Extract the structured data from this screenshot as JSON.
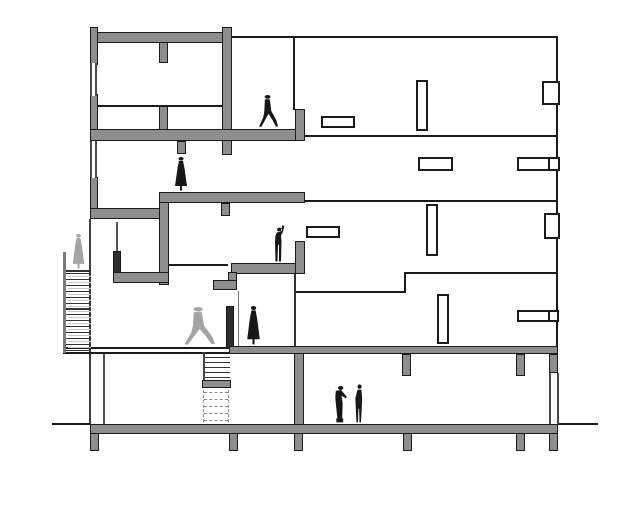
{
  "drawing": {
    "canvas": {
      "w": 635,
      "h": 515
    },
    "palette": {
      "background": "#ffffff",
      "cut_wall_gray": "#8e8e8e",
      "outline_black": "#1b1b1b",
      "dark_wall": "#2e2e2e",
      "light_figure_gray": "#a4a4a4",
      "dark_figure": "#171717",
      "tread_light": "#c7c7c7",
      "dashed_gray": "#8a8a8a"
    },
    "thin_lines": [
      {
        "n": "roof-edge-line",
        "x": 231,
        "y": 36,
        "w": 327,
        "h": 2
      },
      {
        "n": "right-facade-line",
        "x": 556,
        "y": 36,
        "w": 2,
        "h": 312
      },
      {
        "n": "mid-facade-line",
        "x": 293,
        "y": 38,
        "w": 2,
        "h": 72
      },
      {
        "n": "floor2-line",
        "x": 303,
        "y": 135,
        "w": 255,
        "h": 2
      },
      {
        "n": "floor3-line",
        "x": 303,
        "y": 200,
        "w": 255,
        "h": 2
      },
      {
        "n": "floor4-high-line",
        "x": 404,
        "y": 272,
        "w": 154,
        "h": 2
      },
      {
        "n": "floor4-step-line",
        "x": 404,
        "y": 272,
        "w": 2,
        "h": 21
      },
      {
        "n": "floor4-low-line",
        "x": 296,
        "y": 291,
        "w": 110,
        "h": 2
      },
      {
        "n": "mezzanine-line",
        "x": 97,
        "y": 105,
        "w": 126,
        "h": 2
      },
      {
        "n": "left-facade-line",
        "x": 89,
        "y": 219,
        "w": 2,
        "h": 206,
        "c": "#3d3d3d"
      },
      {
        "n": "partition-line",
        "x": 103,
        "y": 353,
        "w": 2,
        "h": 72,
        "c": "#555555"
      },
      {
        "n": "rail-line-upper",
        "x": 116,
        "y": 222,
        "w": 2,
        "h": 31,
        "c": "#555555"
      },
      {
        "n": "rail-line-mid",
        "x": 168,
        "y": 264,
        "w": 60,
        "h": 2
      },
      {
        "n": "stair-wall-line",
        "x": 238,
        "y": 291,
        "w": 1,
        "h": 57,
        "c": "#777777"
      },
      {
        "n": "platform-support-line",
        "x": 294,
        "y": 274,
        "w": 2,
        "h": 74,
        "c": "#333333"
      },
      {
        "n": "ground-line-left",
        "x": 52,
        "y": 423,
        "w": 38,
        "h": 2
      },
      {
        "n": "ground-line-right",
        "x": 558,
        "y": 423,
        "w": 40,
        "h": 2
      },
      {
        "n": "floor1-line-top",
        "x": 63,
        "y": 347,
        "w": 167,
        "h": 2
      },
      {
        "n": "floor1-line-bottom",
        "x": 63,
        "y": 352,
        "w": 167,
        "h": 2
      },
      {
        "n": "left-stair-rail",
        "x": 63,
        "y": 252,
        "w": 3,
        "h": 101,
        "c": "#7a7a7a"
      },
      {
        "n": "basement-stair-line",
        "x": 203,
        "y": 352,
        "w": 2,
        "h": 36,
        "c": "#444444"
      },
      {
        "n": "left-stair-platform-line",
        "x": 66,
        "y": 270,
        "w": 25,
        "h": 2,
        "c": "#333333"
      }
    ],
    "walls": [
      {
        "n": "roof-slab",
        "x": 90,
        "y": 32,
        "w": 142,
        "h": 11
      },
      {
        "n": "left-parapet",
        "x": 90,
        "y": 27,
        "w": 8,
        "h": 38
      },
      {
        "n": "left-wall-mid",
        "x": 90,
        "y": 94,
        "w": 8,
        "h": 40
      },
      {
        "n": "roof-hanging-wall",
        "x": 159,
        "y": 42,
        "w": 9,
        "h": 21
      },
      {
        "n": "top-block-right-wall",
        "x": 222,
        "y": 27,
        "w": 10,
        "h": 128
      },
      {
        "n": "mezzanine-wall",
        "x": 159,
        "y": 106,
        "w": 9,
        "h": 28
      },
      {
        "n": "floor-slab-a",
        "x": 90,
        "y": 129,
        "w": 215,
        "h": 12
      },
      {
        "n": "hanging-stub-a",
        "x": 177,
        "y": 141,
        "w": 9,
        "h": 13
      },
      {
        "n": "parapet-upper-right",
        "x": 295,
        "y": 109,
        "w": 10,
        "h": 32
      },
      {
        "n": "left-wall-lower",
        "x": 90,
        "y": 177,
        "w": 8,
        "h": 42
      },
      {
        "n": "floor-slab-b",
        "x": 90,
        "y": 208,
        "w": 76,
        "h": 11
      },
      {
        "n": "step-wall",
        "x": 159,
        "y": 192,
        "w": 10,
        "h": 93
      },
      {
        "n": "floor-slab-c",
        "x": 159,
        "y": 192,
        "w": 146,
        "h": 11
      },
      {
        "n": "hanging-stub-c",
        "x": 221,
        "y": 203,
        "w": 9,
        "h": 13
      },
      {
        "n": "landing-parapet",
        "x": 113,
        "y": 251,
        "w": 8,
        "h": 24,
        "f": "dark"
      },
      {
        "n": "floor-slab-d",
        "x": 113,
        "y": 272,
        "w": 56,
        "h": 11
      },
      {
        "n": "viewing-platform-slab",
        "x": 231,
        "y": 263,
        "w": 74,
        "h": 11
      },
      {
        "n": "platform-step-wall",
        "x": 228,
        "y": 272,
        "w": 9,
        "h": 11
      },
      {
        "n": "platform-step-slab",
        "x": 213,
        "y": 280,
        "w": 24,
        "h": 10
      },
      {
        "n": "platform-parapet",
        "x": 295,
        "y": 241,
        "w": 10,
        "h": 33
      },
      {
        "n": "stair-side-wall",
        "x": 226,
        "y": 306,
        "w": 8,
        "h": 43,
        "f": "dark"
      },
      {
        "n": "core-wall-ground",
        "x": 294,
        "y": 351,
        "w": 10,
        "h": 82
      },
      {
        "n": "floor-slab-first",
        "x": 229,
        "y": 346,
        "w": 329,
        "h": 8
      },
      {
        "n": "column-stub",
        "x": 402,
        "y": 354,
        "w": 9,
        "h": 22
      },
      {
        "n": "column-stub",
        "x": 516,
        "y": 354,
        "w": 9,
        "h": 22
      },
      {
        "n": "column-stub",
        "x": 549,
        "y": 354,
        "w": 9,
        "h": 19
      },
      {
        "n": "ground-slab",
        "x": 90,
        "y": 424,
        "w": 468,
        "h": 10
      },
      {
        "n": "foundation-pier",
        "x": 90,
        "y": 433,
        "w": 9,
        "h": 18
      },
      {
        "n": "foundation-pier",
        "x": 229,
        "y": 433,
        "w": 9,
        "h": 18
      },
      {
        "n": "foundation-pier",
        "x": 294,
        "y": 433,
        "w": 9,
        "h": 18
      },
      {
        "n": "foundation-pier",
        "x": 403,
        "y": 433,
        "w": 9,
        "h": 18
      },
      {
        "n": "foundation-pier",
        "x": 516,
        "y": 433,
        "w": 9,
        "h": 18
      },
      {
        "n": "foundation-pier",
        "x": 549,
        "y": 433,
        "w": 9,
        "h": 18
      },
      {
        "n": "mid-stair-landing",
        "x": 202,
        "y": 380,
        "w": 29,
        "h": 8
      }
    ],
    "glazing": [
      {
        "n": "glazing-left-upper",
        "x": 90,
        "y": 63,
        "w": 7,
        "h": 33
      },
      {
        "n": "glazing-left-mid",
        "x": 90,
        "y": 141,
        "w": 7,
        "h": 37
      },
      {
        "n": "glazing-ground-right",
        "x": 549,
        "y": 373,
        "w": 10,
        "h": 51
      }
    ],
    "windows": [
      {
        "n": "window",
        "x": 321,
        "y": 116,
        "w": 34,
        "h": 12
      },
      {
        "n": "window",
        "x": 416,
        "y": 80,
        "w": 12,
        "h": 51
      },
      {
        "n": "window",
        "x": 542,
        "y": 81,
        "w": 18,
        "h": 24
      },
      {
        "n": "window",
        "x": 418,
        "y": 157,
        "w": 35,
        "h": 14
      },
      {
        "n": "window",
        "x": 517,
        "y": 157,
        "w": 33,
        "h": 14
      },
      {
        "n": "window",
        "x": 548,
        "y": 157,
        "w": 12,
        "h": 14
      },
      {
        "n": "window",
        "x": 426,
        "y": 204,
        "w": 12,
        "h": 52
      },
      {
        "n": "window",
        "x": 544,
        "y": 213,
        "w": 16,
        "h": 26
      },
      {
        "n": "window",
        "x": 306,
        "y": 226,
        "w": 34,
        "h": 12
      },
      {
        "n": "window",
        "x": 437,
        "y": 294,
        "w": 12,
        "h": 50
      },
      {
        "n": "window",
        "x": 517,
        "y": 310,
        "w": 33,
        "h": 12
      },
      {
        "n": "window",
        "x": 548,
        "y": 310,
        "w": 11,
        "h": 12
      }
    ],
    "stair_runs": [
      {
        "n": "left-exterior-stair",
        "x": 66,
        "w": 25,
        "y0": 273,
        "step": 5.9,
        "count": 14,
        "double": true
      },
      {
        "n": "basement-stair",
        "x": 205,
        "w": 25,
        "y0": 357,
        "step": 5,
        "count": 5
      }
    ],
    "dashed": [
      {
        "n": "hidden-stair-outline",
        "x": 203,
        "y": 390,
        "w": 26,
        "h": 32,
        "rows": 5
      }
    ],
    "figures": [
      {
        "n": "person-walking-top",
        "type": "person-walking",
        "x": 257,
        "y": 95,
        "w": 21,
        "h": 34,
        "tone": "dark"
      },
      {
        "n": "person-dress-mid",
        "type": "person-dress",
        "x": 171,
        "y": 157,
        "w": 20,
        "h": 35,
        "tone": "dark"
      },
      {
        "n": "person-raised-arm",
        "type": "person-raised-arm",
        "x": 269,
        "y": 225,
        "w": 20,
        "h": 38,
        "tone": "dark"
      },
      {
        "n": "person-on-stair",
        "type": "person-dress",
        "x": 69,
        "y": 234,
        "w": 19,
        "h": 36,
        "tone": "light"
      },
      {
        "n": "person-walking-ground",
        "type": "person-walking",
        "x": 181,
        "y": 307,
        "w": 34,
        "h": 40,
        "tone": "light"
      },
      {
        "n": "person-dress-ground",
        "type": "person-dress",
        "x": 243,
        "y": 306,
        "w": 21,
        "h": 40,
        "tone": "dark"
      },
      {
        "n": "person-leaning-basement",
        "type": "person-leaning",
        "x": 329,
        "y": 384,
        "w": 21,
        "h": 40,
        "tone": "dark"
      },
      {
        "n": "person-standing-basement",
        "type": "person-standing",
        "x": 352,
        "y": 384,
        "w": 15,
        "h": 40,
        "tone": "dark"
      }
    ]
  }
}
